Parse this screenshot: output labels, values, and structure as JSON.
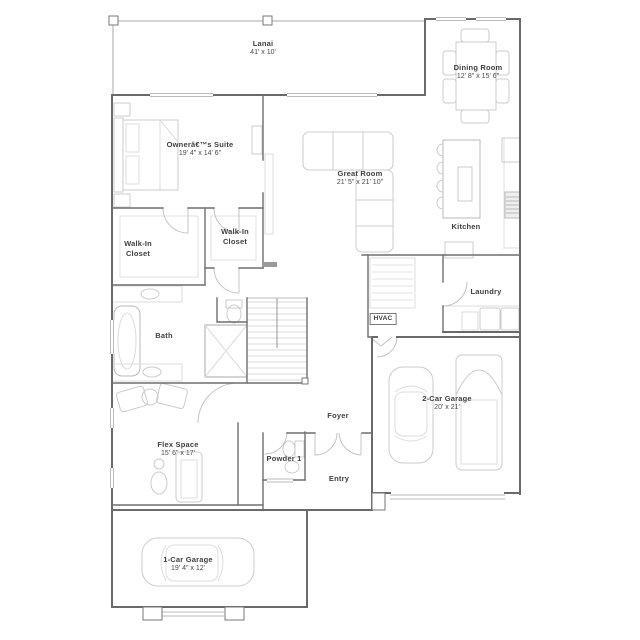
{
  "plan": {
    "rooms": {
      "lanai": {
        "label": "Lanai",
        "dims": "41' x 10'"
      },
      "dining_room": {
        "label": "Dining Room",
        "dims": "12' 8\" x 15' 6\""
      },
      "owners_suite": {
        "label": "Ownerâ€™s Suite",
        "dims": "19' 4\" x 14' 6\""
      },
      "great_room": {
        "label": "Great Room",
        "dims": "21' 5\" x 21' 10\""
      },
      "kitchen": {
        "label": "Kitchen",
        "dims": ""
      },
      "walk_in_closet_1": {
        "label": "Walk-In Closet",
        "dims": ""
      },
      "walk_in_closet_2": {
        "label": "Walk-In Closet",
        "dims": ""
      },
      "laundry": {
        "label": "Laundry",
        "dims": ""
      },
      "hvac": {
        "label": "HVAC",
        "dims": ""
      },
      "bath": {
        "label": "Bath",
        "dims": ""
      },
      "foyer": {
        "label": "Foyer",
        "dims": ""
      },
      "two_car_garage": {
        "label": "2-Car Garage",
        "dims": "20' x 21'"
      },
      "flex_space": {
        "label": "Flex Space",
        "dims": "15' 6\" x 17'"
      },
      "powder": {
        "label": "Powder 1",
        "dims": ""
      },
      "entry": {
        "label": "Entry",
        "dims": ""
      },
      "one_car_garage": {
        "label": "1-Car Garage",
        "dims": "19' 4\" x 12'"
      }
    },
    "colors": {
      "wall": "#6a6a6a",
      "furniture": "#cccccc",
      "text": "#3f3f3f"
    }
  }
}
